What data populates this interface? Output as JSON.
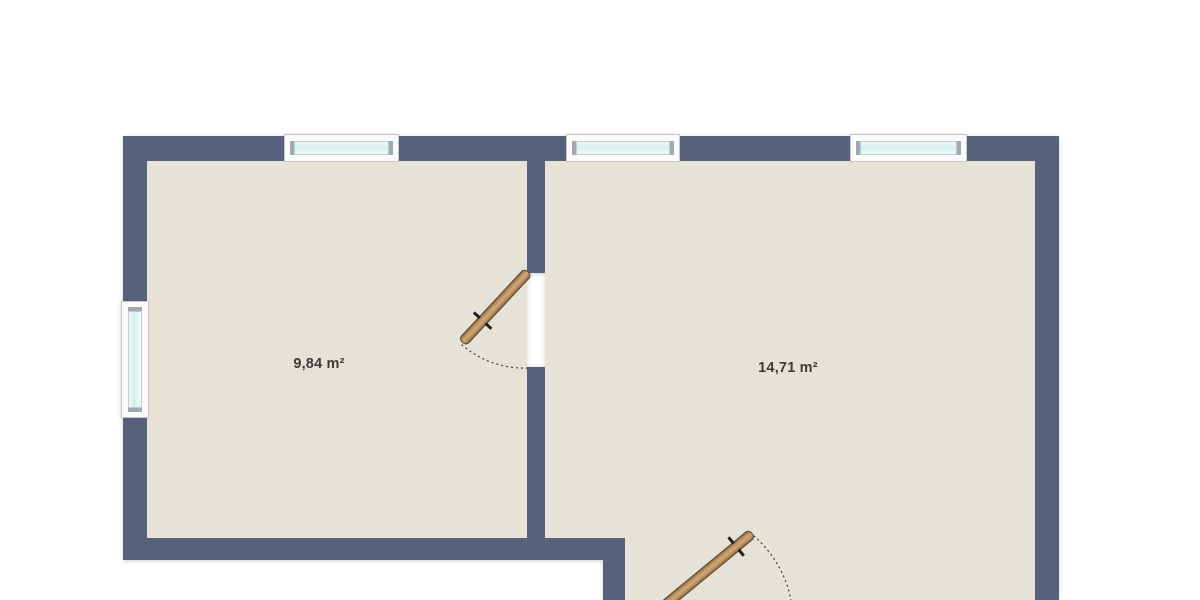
{
  "rooms": [
    {
      "id": "room-left",
      "area_label": "9,84 m²",
      "area_m2": 9.84
    },
    {
      "id": "room-right",
      "area_label": "14,71 m²",
      "area_m2": 14.71
    }
  ],
  "elements": {
    "windows": [
      "window-top-left",
      "window-top-middle",
      "window-top-right",
      "window-left"
    ],
    "doors": [
      "door-interior",
      "door-bottom"
    ]
  },
  "colors": {
    "wall": "#57617b",
    "floor": "#e6e2d8",
    "window_frame": "#fbfbfb",
    "window_glass": "#d8f1ef",
    "door_leaf": "#b68e5d",
    "swing_arc": "#4a4a4a",
    "background": "#ffffff",
    "label_text": "#3b3b3b"
  }
}
